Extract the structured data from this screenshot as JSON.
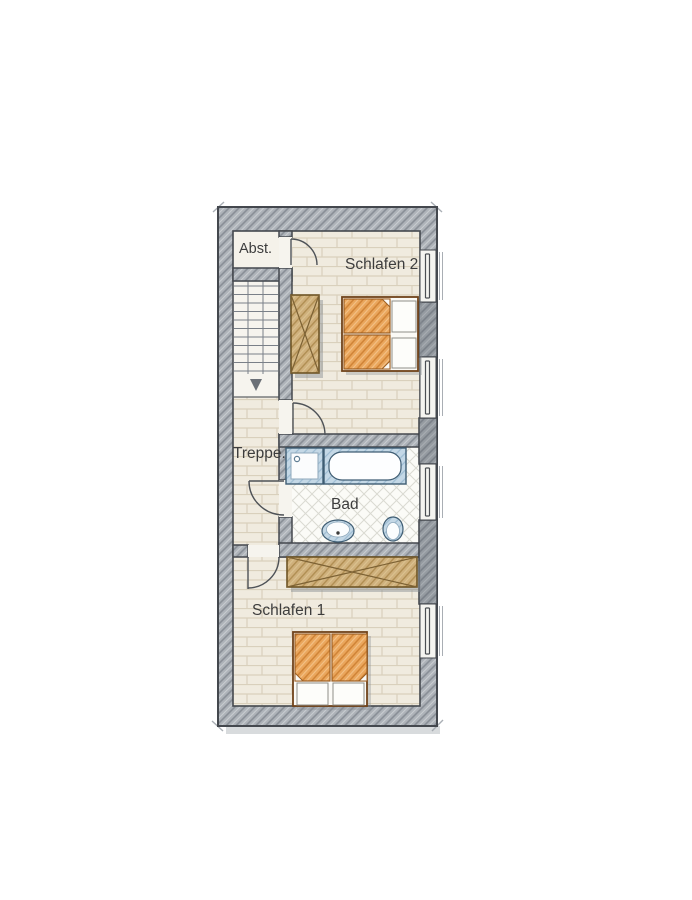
{
  "floorplan": {
    "labels": {
      "storage": "Abst.",
      "bedroom2": "Schlafen 2",
      "stairs": "Treppe.",
      "bathroom": "Bad",
      "bedroom1": "Schlafen 1"
    },
    "colors": {
      "wall_gray": "#aeb3b9",
      "pier_gray": "#8e949c",
      "floor_beige": "#f0ebdf",
      "bath_tile_white": "#fbfbf7",
      "furniture_wood": "#cfb07c",
      "mattress_orange": "#eaa65c",
      "sanitary_blue": "#c4d8e6",
      "outline_dark": "#44484e",
      "label_text": "#3d3d3d"
    }
  }
}
